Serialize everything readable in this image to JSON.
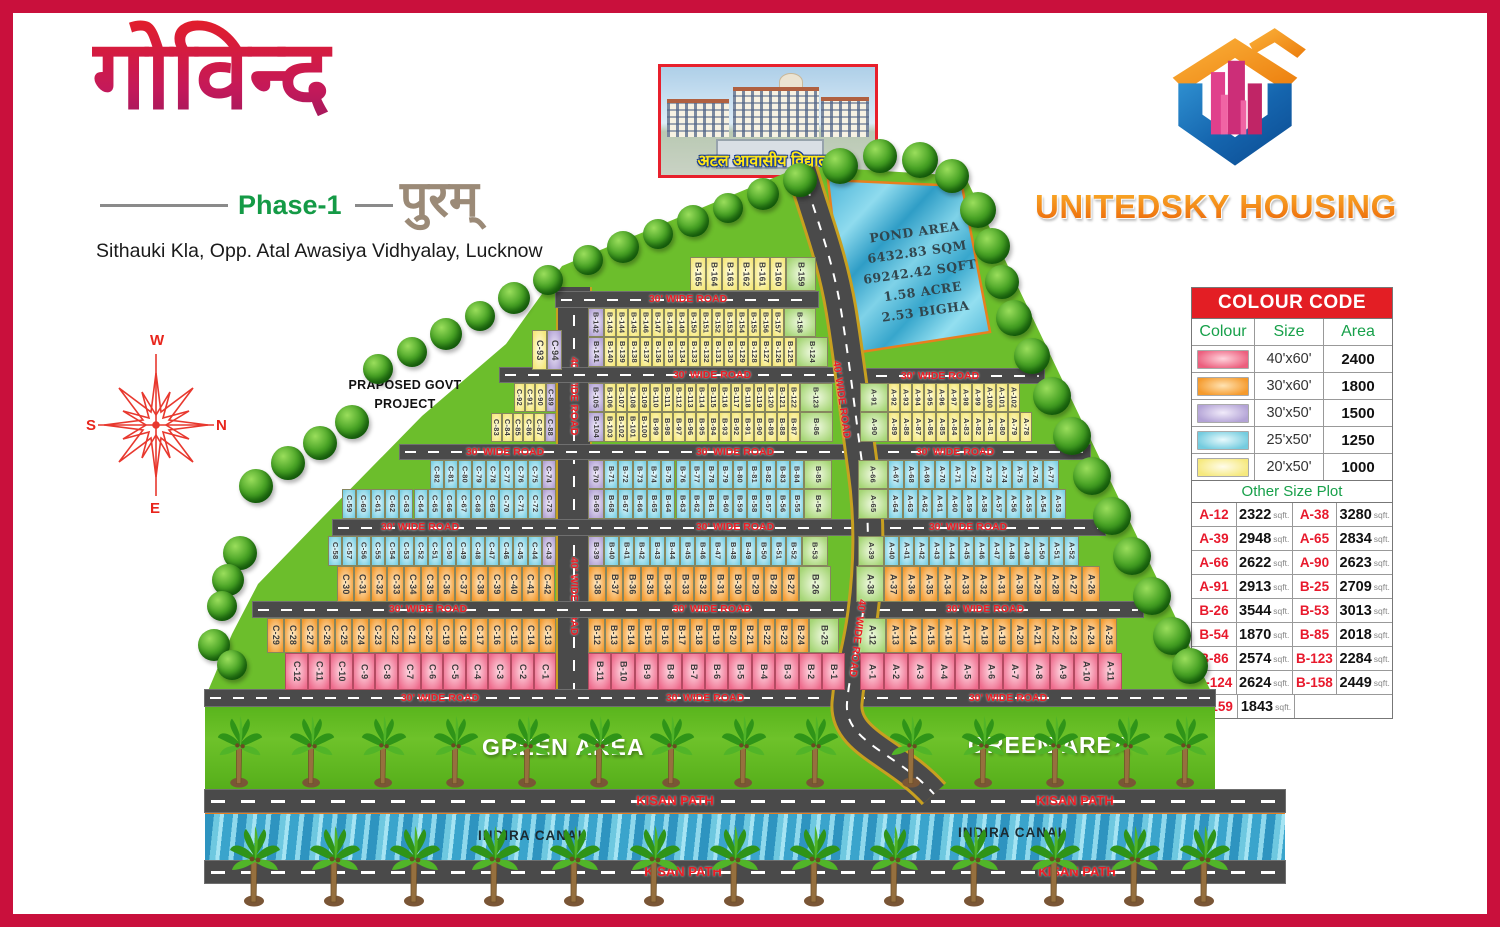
{
  "header": {
    "title_hindi": "गोविन्द",
    "phase": "Phase-1",
    "subtitle_hindi": "पुरम्",
    "address": "Sithauki Kla, Opp. Atal Awasiya Vidhyalay, Lucknow",
    "school_caption": "अटल आवासीय विद्यालय",
    "company": "UNITEDSKY HOUSING"
  },
  "compass": {
    "top": "W",
    "right": "N",
    "bottom": "E",
    "left": "S"
  },
  "notes": {
    "govt_line1": "PRAPOSED GOVT",
    "govt_line2": "PROJECT"
  },
  "pond": {
    "lines": [
      "POND AREA",
      "6432.83 SQM",
      "69242.42 SQFT",
      "1.58 ACRE",
      "2.53 BIGHA"
    ]
  },
  "labels": {
    "green_area": "GREEN AREA",
    "kisan_path": "KISAN PATH",
    "indira_canal": "INDIRA CANAL",
    "road_30": "30' WIDE ROAD",
    "road_40": "40' WIDE ROAD"
  },
  "colour_code": {
    "title": "COLOUR CODE",
    "columns": [
      "Colour",
      "Size",
      "Area"
    ],
    "rows": [
      {
        "color": "pink",
        "size": "40'x60'",
        "area": "2400"
      },
      {
        "color": "orange",
        "size": "30'x60'",
        "area": "1800"
      },
      {
        "color": "purple",
        "size": "30'x50'",
        "area": "1500"
      },
      {
        "color": "cyan",
        "size": "25'x50'",
        "area": "1250"
      },
      {
        "color": "yellow",
        "size": "20'x50'",
        "area": "1000"
      }
    ]
  },
  "other_size": {
    "title": "Other Size Plot",
    "unit": "sqft.",
    "entries": [
      [
        "A-12",
        "2322"
      ],
      [
        "A-38",
        "3280"
      ],
      [
        "A-39",
        "2948"
      ],
      [
        "A-65",
        "2834"
      ],
      [
        "A-66",
        "2622"
      ],
      [
        "A-90",
        "2623"
      ],
      [
        "A-91",
        "2913"
      ],
      [
        "B-25",
        "2709"
      ],
      [
        "B-26",
        "3544"
      ],
      [
        "B-53",
        "3013"
      ],
      [
        "B-54",
        "1870"
      ],
      [
        "B-85",
        "2018"
      ],
      [
        "B-86",
        "2574"
      ],
      [
        "B-123",
        "2284"
      ],
      [
        "B-124",
        "2624"
      ],
      [
        "B-158",
        "2449"
      ],
      [
        "B-159",
        "1843"
      ]
    ]
  },
  "plan": {
    "rows": [
      {
        "x": 532,
        "y": 330,
        "h": 40,
        "pw": 15,
        "g": [
          {
            "c": "yellow",
            "l": [
              "C-93"
            ]
          },
          {
            "c": "purple",
            "l": [
              "C-94"
            ]
          }
        ]
      },
      {
        "x": 514,
        "y": 383,
        "h": 29,
        "pw": 10.5,
        "g": [
          {
            "c": "yellow",
            "l": [
              "C-92",
              "C-91",
              "C-90"
            ]
          },
          {
            "c": "purple",
            "l": [
              "C-89"
            ]
          }
        ]
      },
      {
        "x": 491,
        "y": 413,
        "h": 29,
        "pw": 10.8,
        "g": [
          {
            "c": "yellow",
            "l": [
              "C-83",
              "C-84",
              "C-85",
              "C-86",
              "C-87"
            ]
          },
          {
            "c": "purple",
            "l": [
              "C-88"
            ]
          }
        ]
      },
      {
        "x": 430,
        "y": 460,
        "h": 29,
        "pw": 14,
        "g": [
          {
            "c": "cyan",
            "l": [
              "C-82",
              "C-81",
              "C-80",
              "C-79",
              "C-78",
              "C-77",
              "C-76",
              "C-75"
            ]
          },
          {
            "c": "purple",
            "l": [
              "C-74"
            ]
          }
        ]
      },
      {
        "x": 342,
        "y": 489,
        "h": 30,
        "pw": 14.3,
        "g": [
          {
            "c": "cyan",
            "l": [
              "C-59",
              "C-60",
              "C-61",
              "C-62",
              "C-63",
              "C-64",
              "C-65",
              "C-66",
              "C-67",
              "C-68",
              "C-69",
              "C-70",
              "C-71",
              "C-72"
            ]
          },
          {
            "c": "purple",
            "l": [
              "C-73"
            ]
          }
        ]
      },
      {
        "x": 328,
        "y": 536,
        "h": 30,
        "pw": 14.25,
        "g": [
          {
            "c": "cyan",
            "l": [
              "C-58",
              "C-57",
              "C-56",
              "C-55",
              "C-54",
              "C-53",
              "C-52",
              "C-51",
              "C-50",
              "C-49",
              "C-48",
              "C-47",
              "C-46",
              "C-45",
              "C-44"
            ]
          },
          {
            "c": "purple",
            "l": [
              "C-43"
            ]
          }
        ]
      },
      {
        "x": 337,
        "y": 566,
        "h": 36,
        "pw": 16.8,
        "g": [
          {
            "c": "orange",
            "l": [
              "C-30",
              "C-31",
              "C-32",
              "C-33",
              "C-34",
              "C-35",
              "C-36",
              "C-37",
              "C-38",
              "C-39",
              "C-40",
              "C-41",
              "C-42"
            ]
          }
        ]
      },
      {
        "x": 267,
        "y": 618,
        "h": 35,
        "pw": 17,
        "g": [
          {
            "c": "orange",
            "l": [
              "C-29",
              "C-28",
              "C-27",
              "C-26",
              "C-25",
              "C-24",
              "C-23",
              "C-22",
              "C-21",
              "C-20",
              "C-19",
              "C-18",
              "C-17",
              "C-16",
              "C-15",
              "C-14",
              "C-13"
            ]
          }
        ]
      },
      {
        "x": 285,
        "y": 653,
        "h": 37,
        "pw": 22.6,
        "g": [
          {
            "c": "pink",
            "l": [
              "C-12",
              "C-11",
              "C-10",
              "C-9",
              "C-8",
              "C-7",
              "C-6",
              "C-5",
              "C-4",
              "C-3",
              "C-2",
              "C-1"
            ]
          }
        ]
      },
      {
        "x": 690,
        "y": 257,
        "h": 34,
        "pw": 16,
        "g": [
          {
            "c": "yellow",
            "l": [
              "B-165",
              "B-164",
              "B-163",
              "B-162",
              "B-161",
              "B-160"
            ]
          },
          {
            "c": "green",
            "w": 30,
            "l": [
              "B-159"
            ]
          }
        ]
      },
      {
        "x": 588,
        "y": 308,
        "h": 29,
        "pw": 12,
        "g": [
          {
            "c": "purple",
            "w": 16,
            "l": [
              "B-142"
            ]
          },
          {
            "c": "yellow",
            "l": [
              "B-143",
              "B-144",
              "B-145",
              "B-146",
              "B-147",
              "B-148",
              "B-149",
              "B-150",
              "B-151",
              "B-152",
              "B-153",
              "B-154",
              "B-155",
              "B-156",
              "B-157"
            ]
          },
          {
            "c": "green",
            "w": 32,
            "l": [
              "B-158"
            ]
          }
        ]
      },
      {
        "x": 588,
        "y": 337,
        "h": 30,
        "pw": 12,
        "g": [
          {
            "c": "purple",
            "w": 16,
            "l": [
              "B-141"
            ]
          },
          {
            "c": "yellow",
            "l": [
              "B-140",
              "B-139",
              "B-138",
              "B-137",
              "B-136",
              "B-135",
              "B-134",
              "B-133",
              "B-132",
              "B-131",
              "B-130",
              "B-129",
              "B-128",
              "B-127",
              "B-126",
              "B-125"
            ]
          },
          {
            "c": "green",
            "w": 32,
            "l": [
              "B-124"
            ]
          }
        ]
      },
      {
        "x": 588,
        "y": 383,
        "h": 29,
        "pw": 11.5,
        "g": [
          {
            "c": "purple",
            "w": 16,
            "l": [
              "B-105"
            ]
          },
          {
            "c": "yellow",
            "l": [
              "B-106",
              "B-107",
              "B-108",
              "B-109",
              "B-110",
              "B-111",
              "B-112",
              "B-113",
              "B-114",
              "B-115",
              "B-116",
              "B-117",
              "B-118",
              "B-119",
              "B-120",
              "B-121",
              "B-122"
            ]
          },
          {
            "c": "green",
            "w": 33,
            "l": [
              "B-123"
            ]
          }
        ]
      },
      {
        "x": 588,
        "y": 412,
        "h": 30,
        "pw": 11.5,
        "g": [
          {
            "c": "purple",
            "w": 16,
            "l": [
              "B-104"
            ]
          },
          {
            "c": "yellow",
            "l": [
              "B-103",
              "B-102",
              "B-101",
              "B-100",
              "B-99",
              "B-98",
              "B-97",
              "B-96",
              "B-95",
              "B-94",
              "B-93",
              "B-92",
              "B-91",
              "B-90",
              "B-89",
              "B-88",
              "B-87"
            ]
          },
          {
            "c": "green",
            "w": 33,
            "l": [
              "B-86"
            ]
          }
        ]
      },
      {
        "x": 588,
        "y": 460,
        "h": 29,
        "pw": 14.3,
        "g": [
          {
            "c": "purple",
            "w": 16,
            "l": [
              "B-70"
            ]
          },
          {
            "c": "cyan",
            "l": [
              "B-71",
              "B-72",
              "B-73",
              "B-74",
              "B-75",
              "B-76",
              "B-77",
              "B-78",
              "B-79",
              "B-80",
              "B-81",
              "B-82",
              "B-83",
              "B-84"
            ]
          },
          {
            "c": "green",
            "w": 28,
            "l": [
              "B-85"
            ]
          }
        ]
      },
      {
        "x": 588,
        "y": 489,
        "h": 30,
        "pw": 14.3,
        "g": [
          {
            "c": "purple",
            "w": 16,
            "l": [
              "B-69"
            ]
          },
          {
            "c": "cyan",
            "l": [
              "B-68",
              "B-67",
              "B-66",
              "B-65",
              "B-64",
              "B-63",
              "B-62",
              "B-61",
              "B-60",
              "B-59",
              "B-58",
              "B-57",
              "B-56",
              "B-55"
            ]
          },
          {
            "c": "green",
            "w": 28,
            "l": [
              "B-54"
            ]
          }
        ]
      },
      {
        "x": 588,
        "y": 536,
        "h": 30,
        "pw": 15.2,
        "g": [
          {
            "c": "purple",
            "w": 16,
            "l": [
              "B-39"
            ]
          },
          {
            "c": "cyan",
            "l": [
              "B-40",
              "B-41",
              "B-42",
              "B-43",
              "B-44",
              "B-45",
              "B-46",
              "B-47",
              "B-48",
              "B-49",
              "B-50",
              "B-51",
              "B-52"
            ]
          },
          {
            "c": "green",
            "w": 26,
            "l": [
              "B-53"
            ]
          }
        ]
      },
      {
        "x": 588,
        "y": 566,
        "h": 36,
        "pw": 17.6,
        "g": [
          {
            "c": "orange",
            "l": [
              "B-38",
              "B-37",
              "B-36",
              "B-35",
              "B-34",
              "B-33",
              "B-32",
              "B-31",
              "B-30",
              "B-29",
              "B-28",
              "B-27"
            ]
          },
          {
            "c": "green",
            "w": 32,
            "l": [
              "B-26"
            ]
          }
        ]
      },
      {
        "x": 588,
        "y": 618,
        "h": 35,
        "pw": 17,
        "g": [
          {
            "c": "orange",
            "l": [
              "B-12",
              "B-13",
              "B-14",
              "B-15",
              "B-16",
              "B-17",
              "B-18",
              "B-19",
              "B-20",
              "B-21",
              "B-22",
              "B-23",
              "B-24"
            ]
          },
          {
            "c": "green",
            "w": 30,
            "l": [
              "B-25"
            ]
          }
        ]
      },
      {
        "x": 588,
        "y": 653,
        "h": 37,
        "pw": 23.4,
        "g": [
          {
            "c": "pink",
            "l": [
              "B-11",
              "B-10",
              "B-9",
              "B-8",
              "B-7",
              "B-6",
              "B-5",
              "B-4",
              "B-3",
              "B-2",
              "B-1"
            ]
          }
        ]
      },
      {
        "x": 860,
        "y": 383,
        "h": 29,
        "pw": 12,
        "g": [
          {
            "c": "green",
            "w": 28,
            "l": [
              "A-91"
            ]
          },
          {
            "c": "yellow",
            "l": [
              "A-92",
              "A-93",
              "A-94",
              "A-95",
              "A-96",
              "A-97",
              "A-98",
              "A-99",
              "A-100",
              "A-101",
              "A-102"
            ]
          }
        ]
      },
      {
        "x": 860,
        "y": 412,
        "h": 30,
        "pw": 12,
        "g": [
          {
            "c": "green",
            "w": 28,
            "l": [
              "A-90"
            ]
          },
          {
            "c": "yellow",
            "l": [
              "A-89",
              "A-88",
              "A-87",
              "A-86",
              "A-85",
              "A-84",
              "A-83",
              "A-82",
              "A-81",
              "A-80",
              "A-79",
              "A-78"
            ]
          }
        ]
      },
      {
        "x": 858,
        "y": 460,
        "h": 29,
        "pw": 15.5,
        "g": [
          {
            "c": "green",
            "w": 30,
            "l": [
              "A-66"
            ]
          },
          {
            "c": "cyan",
            "l": [
              "A-67",
              "A-68",
              "A-69",
              "A-70",
              "A-71",
              "A-72",
              "A-73",
              "A-74",
              "A-75",
              "A-76",
              "A-77"
            ]
          }
        ]
      },
      {
        "x": 858,
        "y": 489,
        "h": 30,
        "pw": 14.8,
        "g": [
          {
            "c": "green",
            "w": 30,
            "l": [
              "A-65"
            ]
          },
          {
            "c": "cyan",
            "l": [
              "A-64",
              "A-63",
              "A-62",
              "A-61",
              "A-60",
              "A-59",
              "A-58",
              "A-57",
              "A-56",
              "A-55",
              "A-54",
              "A-53"
            ]
          }
        ]
      },
      {
        "x": 858,
        "y": 536,
        "h": 30,
        "pw": 15,
        "g": [
          {
            "c": "green",
            "w": 26,
            "l": [
              "A-39"
            ]
          },
          {
            "c": "cyan",
            "l": [
              "A-40",
              "A-41",
              "A-42",
              "A-43",
              "A-44",
              "A-45",
              "A-46",
              "A-47",
              "A-48",
              "A-49",
              "A-50",
              "A-51",
              "A-52"
            ]
          }
        ]
      },
      {
        "x": 856,
        "y": 566,
        "h": 36,
        "pw": 18,
        "g": [
          {
            "c": "green",
            "w": 28,
            "l": [
              "A-38"
            ]
          },
          {
            "c": "orange",
            "l": [
              "A-37",
              "A-36",
              "A-35",
              "A-34",
              "A-33",
              "A-32",
              "A-31",
              "A-30",
              "A-29",
              "A-28",
              "A-27",
              "A-26"
            ]
          }
        ]
      },
      {
        "x": 858,
        "y": 618,
        "h": 35,
        "pw": 17.8,
        "g": [
          {
            "c": "green",
            "w": 28,
            "l": [
              "A-12"
            ]
          },
          {
            "c": "orange",
            "l": [
              "A-13",
              "A-14",
              "A-15",
              "A-16",
              "A-17",
              "A-18",
              "A-19",
              "A-20",
              "A-21",
              "A-22",
              "A-23",
              "A-24",
              "A-25"
            ]
          }
        ]
      },
      {
        "x": 860,
        "y": 653,
        "h": 37,
        "pw": 23.8,
        "g": [
          {
            "c": "pink",
            "l": [
              "A-1",
              "A-2",
              "A-3",
              "A-4",
              "A-5",
              "A-6",
              "A-7",
              "A-8",
              "A-9",
              "A-10",
              "A-11"
            ]
          }
        ]
      }
    ]
  }
}
